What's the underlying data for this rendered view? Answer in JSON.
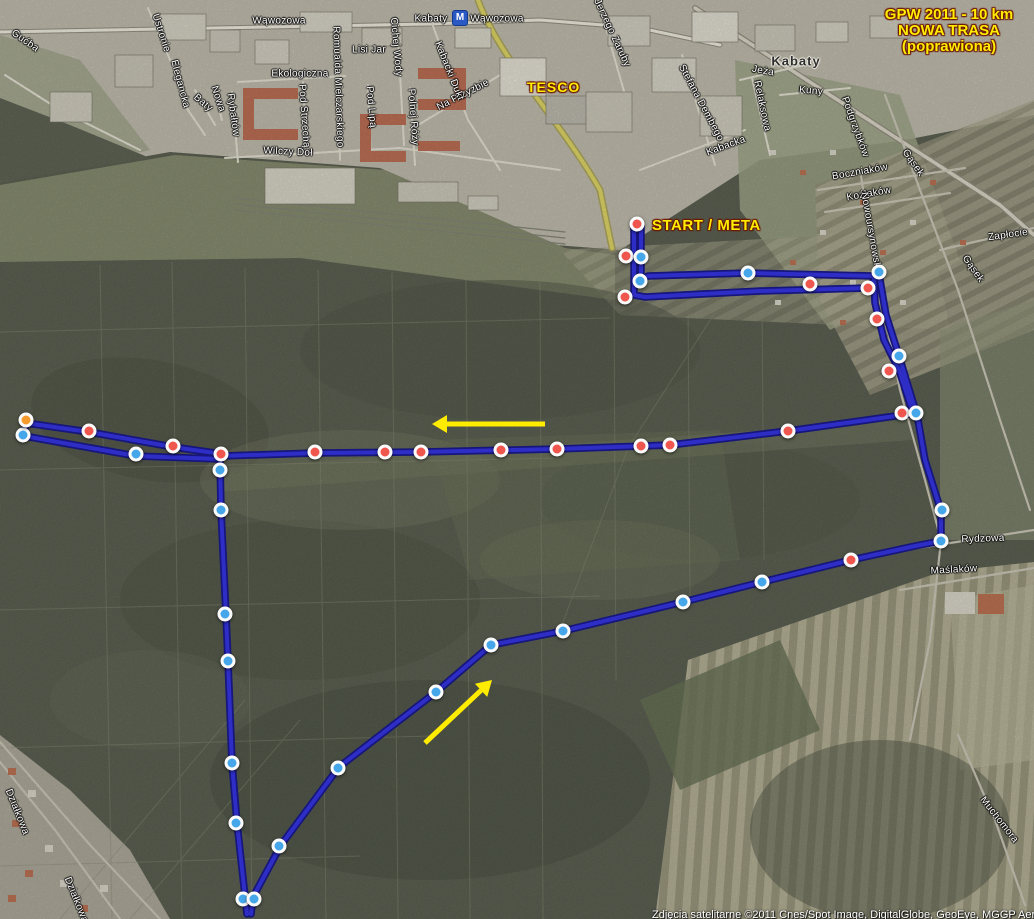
{
  "title": {
    "line1": "GPW 2011 - 10 km",
    "line2": "NOWA TRASA",
    "line3": "(poprawiona)"
  },
  "annotations": {
    "start_meta": "START / META",
    "tesco": "TESCO",
    "copyright": "Zdjęcia satelitarne ©2011 Cnes/Spot Image, DigitalGlobe, GeoEye, MGGP Aero, P"
  },
  "metro": {
    "m": "M"
  },
  "colors": {
    "route": "#2e2ec6",
    "route_casing": "#16167c",
    "arrow": "#ffec00",
    "marker_red": "#ee564e",
    "marker_blue": "#45a7ea",
    "marker_orange": "#f59b2e"
  },
  "map": {
    "street_labels": [
      {
        "t": "Gućba",
        "x": 25,
        "y": 41,
        "r": 35
      },
      {
        "t": "Ustronie",
        "x": 161,
        "y": 33,
        "r": 72
      },
      {
        "t": "Elegancka",
        "x": 180,
        "y": 84,
        "r": 75
      },
      {
        "t": "Baty",
        "x": 203,
        "y": 103,
        "r": 40
      },
      {
        "t": "Nowa",
        "x": 218,
        "y": 99,
        "r": 72
      },
      {
        "t": "Rybałtów",
        "x": 233,
        "y": 115,
        "r": 82
      },
      {
        "t": "Wąwozowa",
        "x": 279,
        "y": 21,
        "r": 0
      },
      {
        "t": "Ekologiczna",
        "x": 300,
        "y": 74,
        "r": 0
      },
      {
        "t": "Romualda Mielczarskiego",
        "x": 338,
        "y": 87,
        "r": 88
      },
      {
        "t": "Lisi Jar",
        "x": 369,
        "y": 50,
        "r": 0
      },
      {
        "t": "Cichej Wody",
        "x": 396,
        "y": 47,
        "r": 85
      },
      {
        "t": "Pod Lipą",
        "x": 371,
        "y": 107,
        "r": 85
      },
      {
        "t": "Polnej Róży",
        "x": 413,
        "y": 117,
        "r": 86
      },
      {
        "t": "Pod Strzechą",
        "x": 304,
        "y": 116,
        "r": 86
      },
      {
        "t": "Wilczy Dół",
        "x": 288,
        "y": 152,
        "r": 3
      },
      {
        "t": "Na Przyzbie",
        "x": 463,
        "y": 95,
        "r": -27
      },
      {
        "t": "Kabacki Dukt",
        "x": 449,
        "y": 71,
        "r": 68
      },
      {
        "t": "Kabaty",
        "x": 431,
        "y": 19,
        "r": 0
      },
      {
        "t": "Wąwozowa",
        "x": 497,
        "y": 19,
        "r": 0
      },
      {
        "t": "Jerzego Zaruby",
        "x": 612,
        "y": 33,
        "r": 65
      },
      {
        "t": "Stefana Dembego",
        "x": 701,
        "y": 103,
        "r": 62
      },
      {
        "t": "Jeża",
        "x": 763,
        "y": 71,
        "r": 10
      },
      {
        "t": "Kabaty",
        "x": 796,
        "y": 61,
        "r": 0,
        "cls": "district"
      },
      {
        "t": "Kuny",
        "x": 811,
        "y": 91,
        "r": 5
      },
      {
        "t": "Relaksowa",
        "x": 762,
        "y": 106,
        "r": 78
      },
      {
        "t": "Kabacka",
        "x": 726,
        "y": 146,
        "r": -20
      },
      {
        "t": "Podgrzybków",
        "x": 855,
        "y": 127,
        "r": 70
      },
      {
        "t": "Boczniaków",
        "x": 860,
        "y": 172,
        "r": -10
      },
      {
        "t": "Koźlaków",
        "x": 869,
        "y": 194,
        "r": -10
      },
      {
        "t": "Nowoursynowska",
        "x": 871,
        "y": 233,
        "r": 80
      },
      {
        "t": "Gąsek",
        "x": 913,
        "y": 163,
        "r": 55
      },
      {
        "t": "Gąsek",
        "x": 973,
        "y": 269,
        "r": 55
      },
      {
        "t": "Zapłocie",
        "x": 1008,
        "y": 235,
        "r": -8
      },
      {
        "t": "Rydzowa",
        "x": 983,
        "y": 539,
        "r": -2
      },
      {
        "t": "Maślaków",
        "x": 954,
        "y": 570,
        "r": -3
      },
      {
        "t": "Muchomora",
        "x": 999,
        "y": 820,
        "r": 52
      },
      {
        "t": "Działkowa",
        "x": 17,
        "y": 812,
        "r": 68
      },
      {
        "t": "Działkowa",
        "x": 76,
        "y": 900,
        "r": 68
      }
    ]
  },
  "route": {
    "segments": [
      {
        "name": "start-spur-out",
        "points": [
          [
            634,
            226
          ],
          [
            634,
            295
          ],
          [
            645,
            297
          ]
        ]
      },
      {
        "name": "top-east-out",
        "points": [
          [
            645,
            297
          ],
          [
            760,
            291
          ],
          [
            868,
            288
          ],
          [
            879,
            274
          ]
        ]
      },
      {
        "name": "right-descent-out",
        "points": [
          [
            879,
            274
          ],
          [
            886,
            315
          ],
          [
            899,
            356
          ],
          [
            916,
            412
          ]
        ]
      },
      {
        "name": "main-west",
        "points": [
          [
            916,
            413
          ],
          [
            860,
            421
          ],
          [
            788,
            431
          ],
          [
            670,
            445
          ],
          [
            557,
            449
          ],
          [
            421,
            452
          ],
          [
            315,
            453
          ],
          [
            222,
            456
          ]
        ]
      },
      {
        "name": "west-spur-upper",
        "points": [
          [
            222,
            454
          ],
          [
            173,
            447
          ],
          [
            89,
            432
          ],
          [
            26,
            423
          ]
        ]
      },
      {
        "name": "west-spur-turn",
        "points": [
          [
            26,
            423
          ],
          [
            24,
            436
          ]
        ]
      },
      {
        "name": "west-spur-lower",
        "points": [
          [
            24,
            436
          ],
          [
            136,
            456
          ],
          [
            219,
            459
          ]
        ]
      },
      {
        "name": "south-leg",
        "points": [
          [
            220,
            459
          ],
          [
            221,
            510
          ],
          [
            226,
            615
          ],
          [
            228,
            661
          ],
          [
            232,
            763
          ],
          [
            237,
            823
          ],
          [
            245,
            896
          ],
          [
            247,
            914
          ]
        ]
      },
      {
        "name": "diagonal-northeast",
        "points": [
          [
            251,
            914
          ],
          [
            253,
            897
          ],
          [
            281,
            845
          ],
          [
            339,
            767
          ],
          [
            436,
            692
          ],
          [
            491,
            645
          ]
        ]
      },
      {
        "name": "diagonal-to-rydzowa",
        "points": [
          [
            491,
            645
          ],
          [
            563,
            631
          ],
          [
            683,
            602
          ],
          [
            762,
            582
          ],
          [
            851,
            560
          ],
          [
            915,
            546
          ],
          [
            941,
            541
          ]
        ]
      },
      {
        "name": "rydzowa-north",
        "points": [
          [
            941,
            541
          ],
          [
            941,
            511
          ],
          [
            925,
            460
          ],
          [
            917,
            414
          ]
        ]
      },
      {
        "name": "right-ascent-return",
        "points": [
          [
            912,
            410
          ],
          [
            899,
            370
          ],
          [
            884,
            340
          ],
          [
            875,
            303
          ],
          [
            874,
            276
          ]
        ]
      },
      {
        "name": "top-west-return",
        "points": [
          [
            874,
            276
          ],
          [
            748,
            273
          ],
          [
            648,
            276
          ],
          [
            641,
            280
          ]
        ]
      },
      {
        "name": "start-spur-return",
        "points": [
          [
            641,
            280
          ],
          [
            641,
            226
          ]
        ]
      }
    ],
    "markers": [
      {
        "x": 637,
        "y": 224,
        "c": "red"
      },
      {
        "x": 626,
        "y": 256,
        "c": "red"
      },
      {
        "x": 625,
        "y": 297,
        "c": "red"
      },
      {
        "x": 810,
        "y": 284,
        "c": "red"
      },
      {
        "x": 868,
        "y": 288,
        "c": "red"
      },
      {
        "x": 877,
        "y": 319,
        "c": "red"
      },
      {
        "x": 889,
        "y": 371,
        "c": "red"
      },
      {
        "x": 902,
        "y": 413,
        "c": "red"
      },
      {
        "x": 851,
        "y": 560,
        "c": "red"
      },
      {
        "x": 221,
        "y": 454,
        "c": "red"
      },
      {
        "x": 89,
        "y": 431,
        "c": "red"
      },
      {
        "x": 173,
        "y": 446,
        "c": "red"
      },
      {
        "x": 315,
        "y": 452,
        "c": "red"
      },
      {
        "x": 385,
        "y": 452,
        "c": "red"
      },
      {
        "x": 421,
        "y": 452,
        "c": "red"
      },
      {
        "x": 501,
        "y": 450,
        "c": "red"
      },
      {
        "x": 557,
        "y": 449,
        "c": "red"
      },
      {
        "x": 641,
        "y": 446,
        "c": "red"
      },
      {
        "x": 670,
        "y": 445,
        "c": "red"
      },
      {
        "x": 788,
        "y": 431,
        "c": "red"
      },
      {
        "x": 641,
        "y": 257,
        "c": "blue"
      },
      {
        "x": 640,
        "y": 281,
        "c": "blue"
      },
      {
        "x": 748,
        "y": 273,
        "c": "blue"
      },
      {
        "x": 879,
        "y": 272,
        "c": "blue"
      },
      {
        "x": 899,
        "y": 356,
        "c": "blue"
      },
      {
        "x": 916,
        "y": 413,
        "c": "blue"
      },
      {
        "x": 942,
        "y": 510,
        "c": "blue"
      },
      {
        "x": 941,
        "y": 541,
        "c": "blue"
      },
      {
        "x": 762,
        "y": 582,
        "c": "blue"
      },
      {
        "x": 683,
        "y": 602,
        "c": "blue"
      },
      {
        "x": 563,
        "y": 631,
        "c": "blue"
      },
      {
        "x": 491,
        "y": 645,
        "c": "blue"
      },
      {
        "x": 436,
        "y": 692,
        "c": "blue"
      },
      {
        "x": 338,
        "y": 768,
        "c": "blue"
      },
      {
        "x": 279,
        "y": 846,
        "c": "blue"
      },
      {
        "x": 243,
        "y": 899,
        "c": "blue"
      },
      {
        "x": 254,
        "y": 899,
        "c": "blue"
      },
      {
        "x": 236,
        "y": 823,
        "c": "blue"
      },
      {
        "x": 232,
        "y": 763,
        "c": "blue"
      },
      {
        "x": 228,
        "y": 661,
        "c": "blue"
      },
      {
        "x": 225,
        "y": 614,
        "c": "blue"
      },
      {
        "x": 221,
        "y": 510,
        "c": "blue"
      },
      {
        "x": 220,
        "y": 470,
        "c": "blue"
      },
      {
        "x": 136,
        "y": 454,
        "c": "blue"
      },
      {
        "x": 23,
        "y": 435,
        "c": "blue"
      },
      {
        "x": 26,
        "y": 420,
        "c": "orange"
      }
    ],
    "arrows": [
      {
        "x1": 545,
        "y1": 424,
        "x2": 432,
        "y2": 424
      },
      {
        "x1": 425,
        "y1": 743,
        "x2": 492,
        "y2": 680
      }
    ]
  }
}
